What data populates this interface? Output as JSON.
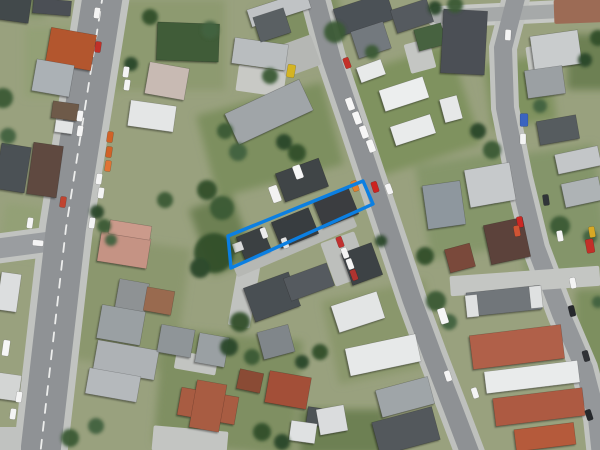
{
  "canvas": {
    "w": 600,
    "h": 450
  },
  "plot": {
    "outline_color": "#0b7fe2",
    "stroke_width": 3.4,
    "points": "228,236 363,181 373,204 231,268"
  },
  "scene": {
    "base_color": "#99a17e",
    "grass_colors": [
      "#8d9a70",
      "#93a076",
      "#7d8f5e",
      "#7f925e",
      "#85966a",
      "#8b976e",
      "#7f8f62",
      "#8a976c",
      "#84956a",
      "#6d8052"
    ],
    "grass": [
      [
        160,
        45,
        130,
        90,
        0,
        0
      ],
      [
        70,
        62,
        90,
        70,
        0,
        1
      ],
      [
        270,
        140,
        130,
        85,
        -15,
        2
      ],
      [
        408,
        112,
        120,
        105,
        -18,
        3
      ],
      [
        470,
        205,
        95,
        95,
        -10,
        4
      ],
      [
        118,
        302,
        130,
        125,
        8,
        5
      ],
      [
        228,
        392,
        140,
        115,
        5,
        6
      ],
      [
        382,
        332,
        105,
        85,
        -12,
        7
      ],
      [
        560,
        212,
        85,
        125,
        -8,
        8
      ],
      [
        300,
        22,
        85,
        45,
        -15,
        6
      ],
      [
        520,
        92,
        65,
        65,
        -8,
        3
      ],
      [
        598,
        332,
        45,
        85,
        0,
        2
      ],
      [
        32,
        232,
        60,
        50,
        8,
        1
      ],
      [
        342,
        432,
        85,
        45,
        0,
        9
      ],
      [
        590,
        62,
        45,
        55,
        0,
        9
      ],
      [
        588,
        5,
        30,
        20,
        0,
        6
      ],
      [
        25,
        5,
        40,
        25,
        0,
        4
      ],
      [
        222,
        235,
        45,
        70,
        -20,
        9
      ]
    ],
    "roads": [
      {
        "name": "side-street",
        "path": "M 54 241 L -6 249",
        "casing_w": 30,
        "casing_color": "#c1c3c0",
        "width": 20,
        "color": "#9a9da0"
      },
      {
        "name": "road-west",
        "path": "M 103 -6 L 66 228 L 40 456",
        "casing_w": 54,
        "casing_color": "#c1c3c0",
        "width": 40,
        "color": "#8f9295",
        "marking": "9 9"
      },
      {
        "name": "road-north-east",
        "path": "M 438 17 L 602 9",
        "casing_w": 22,
        "casing_color": "#c6c8c5",
        "width": 14,
        "color": "#a6a9a9"
      },
      {
        "name": "road-east",
        "path": "M 517 -6 L 503 48 L 505 108 L 519 178 L 536 248 L 561 314 L 584 368 L 597 418 L 601 456",
        "casing_w": 28,
        "casing_color": "#c1c3c0",
        "width": 18,
        "color": "#94979a"
      },
      {
        "name": "road-center",
        "path": "M 314 -6 L 331 58 L 352 120 L 372 180 L 392 240 L 412 300 L 433 357 L 452 406 L 471 456",
        "casing_w": 30,
        "casing_color": "#bec0bd",
        "width": 19,
        "color": "#8e9194"
      }
    ],
    "paved": [
      [
        261,
        81,
        48,
        26,
        8,
        "#c8c9c5"
      ],
      [
        420,
        56,
        26,
        30,
        -15,
        "#c4c6c3"
      ],
      [
        525,
        281,
        150,
        20,
        -4,
        "#c4c6c3"
      ],
      [
        345,
        259,
        36,
        46,
        -20,
        "#bdbfbc"
      ],
      [
        244,
        296,
        22,
        62,
        10,
        "#c0c2bf"
      ],
      [
        196,
        363,
        42,
        18,
        10,
        "#c2c4c1"
      ],
      [
        298,
        56,
        38,
        32,
        -20,
        "#b5b7b4"
      ],
      [
        190,
        441,
        75,
        25,
        5,
        "#c3c5c2"
      ],
      [
        5,
        441,
        32,
        28,
        0,
        "#c0c2c0"
      ],
      [
        543,
        65,
        30,
        40,
        -8,
        "#c2c4c0"
      ],
      [
        295,
        246,
        130,
        13,
        -23,
        "#b6b8b4"
      ],
      [
        580,
        11,
        52,
        24,
        -2,
        "#9c6b55"
      ]
    ],
    "buildings": [
      [
        12,
        9,
        36,
        24,
        8,
        "#43484c"
      ],
      [
        52,
        7,
        38,
        15,
        5,
        "#4b5054"
      ],
      [
        13,
        168,
        30,
        46,
        9,
        "#4c5155"
      ],
      [
        45,
        170,
        30,
        52,
        8,
        "#5e4a40"
      ],
      [
        9,
        292,
        20,
        38,
        8,
        "#dcdedf"
      ],
      [
        9,
        387,
        22,
        26,
        8,
        "#d3d5d4"
      ],
      [
        71,
        49,
        46,
        36,
        10,
        "#b3562f"
      ],
      [
        53,
        78,
        38,
        32,
        10,
        "#abb1b5"
      ],
      [
        65,
        111,
        26,
        17,
        8,
        "#6e5a48"
      ],
      [
        64,
        127,
        18,
        12,
        8,
        "#e3e5e5"
      ],
      [
        124,
        250,
        50,
        30,
        9,
        "#c59384"
      ],
      [
        130,
        230,
        42,
        14,
        9,
        "#cb9a8b"
      ],
      [
        132,
        296,
        30,
        30,
        10,
        "#8e9294"
      ],
      [
        159,
        301,
        28,
        24,
        10,
        "#996a50"
      ],
      [
        121,
        325,
        44,
        34,
        10,
        "#9aa0a3"
      ],
      [
        126,
        360,
        62,
        30,
        10,
        "#aeb2b5"
      ],
      [
        113,
        385,
        52,
        26,
        10,
        "#b5b9bc"
      ],
      [
        176,
        341,
        34,
        28,
        10,
        "#8f9598"
      ],
      [
        212,
        350,
        30,
        30,
        10,
        "#9aa0a3"
      ],
      [
        208,
        406,
        58,
        28,
        10,
        "#a85c42"
      ],
      [
        208,
        406,
        30,
        48,
        10,
        "#a85c42"
      ],
      [
        250,
        381,
        24,
        20,
        12,
        "#8a4c36"
      ],
      [
        288,
        390,
        42,
        32,
        10,
        "#a34f38"
      ],
      [
        318,
        417,
        22,
        18,
        8,
        "#4e5356"
      ],
      [
        303,
        432,
        26,
        20,
        8,
        "#dfe1e2"
      ],
      [
        188,
        42,
        62,
        38,
        2,
        "#3f5c39"
      ],
      [
        167,
        81,
        40,
        32,
        10,
        "#c8bab3"
      ],
      [
        152,
        116,
        46,
        26,
        8,
        "#e4e6e6"
      ],
      [
        260,
        54,
        54,
        26,
        8,
        "#b9bdbf"
      ],
      [
        269,
        112,
        82,
        34,
        -25,
        "#a0a5a8"
      ],
      [
        279,
        9,
        62,
        18,
        -18,
        "#c0c3c5"
      ],
      [
        272,
        25,
        32,
        26,
        -18,
        "#5a6064"
      ],
      [
        302,
        180,
        46,
        30,
        -20,
        "#3f4447"
      ],
      [
        364,
        14,
        56,
        28,
        -18,
        "#4c5156"
      ],
      [
        412,
        16,
        38,
        24,
        -18,
        "#555a5e"
      ],
      [
        371,
        40,
        34,
        28,
        -18,
        "#73797e"
      ],
      [
        430,
        37,
        28,
        22,
        -15,
        "#47623f"
      ],
      [
        254,
        244,
        28,
        26,
        -22,
        "#3b4043"
      ],
      [
        295,
        228,
        40,
        28,
        -22,
        "#393d40"
      ],
      [
        336,
        208,
        38,
        28,
        -22,
        "#3a3e41"
      ],
      [
        238,
        247,
        10,
        9,
        -20,
        "#d8dada"
      ],
      [
        371,
        71,
        26,
        16,
        -20,
        "#e8eaea"
      ],
      [
        404,
        94,
        46,
        22,
        -18,
        "#eceeee"
      ],
      [
        413,
        130,
        42,
        20,
        -18,
        "#e9ebeb"
      ],
      [
        451,
        109,
        18,
        24,
        -15,
        "#e6e8e8"
      ],
      [
        464,
        42,
        44,
        64,
        3,
        "#4b5054"
      ],
      [
        556,
        50,
        48,
        34,
        -8,
        "#c9cccd"
      ],
      [
        545,
        82,
        38,
        28,
        -8,
        "#9ba0a3"
      ],
      [
        578,
        160,
        44,
        20,
        -12,
        "#c3c6c8"
      ],
      [
        582,
        192,
        38,
        24,
        -12,
        "#aeb3b5"
      ],
      [
        558,
        130,
        40,
        24,
        -10,
        "#565b5f"
      ],
      [
        490,
        185,
        46,
        38,
        -10,
        "#c6c9cb"
      ],
      [
        444,
        205,
        38,
        44,
        -8,
        "#8e979e"
      ],
      [
        507,
        241,
        40,
        40,
        -12,
        "#5c423a"
      ],
      [
        460,
        258,
        26,
        24,
        -15,
        "#7a4a3a"
      ],
      [
        362,
        264,
        32,
        34,
        -20,
        "#3d4245"
      ],
      [
        272,
        297,
        48,
        36,
        -20,
        "#4a4f53"
      ],
      [
        309,
        282,
        46,
        24,
        -20,
        "#555a5e"
      ],
      [
        276,
        342,
        32,
        28,
        -15,
        "#80868a"
      ],
      [
        358,
        312,
        48,
        28,
        -18,
        "#e3e5e5"
      ],
      [
        383,
        355,
        72,
        28,
        -12,
        "#e7e9e9"
      ],
      [
        405,
        397,
        54,
        28,
        -15,
        "#9fa5a8"
      ],
      [
        406,
        431,
        62,
        34,
        -15,
        "#53585c"
      ],
      [
        332,
        420,
        28,
        26,
        -10,
        "#dadcdd"
      ],
      [
        504,
        301,
        74,
        24,
        -6,
        "#71767a"
      ],
      [
        472,
        306,
        12,
        22,
        -6,
        "#dfe1e1"
      ],
      [
        536,
        297,
        12,
        22,
        -6,
        "#dfe1e1"
      ],
      [
        517,
        347,
        92,
        34,
        -7,
        "#b06048"
      ],
      [
        532,
        377,
        94,
        22,
        -7,
        "#e9ebeb"
      ],
      [
        539,
        407,
        90,
        28,
        -7,
        "#ad5a42"
      ],
      [
        545,
        437,
        60,
        22,
        -7,
        "#b55a3a"
      ]
    ],
    "tree_colors": [
      "#30502c",
      "#3b5a35",
      "#2b472a",
      "#436240"
    ],
    "trees": [
      [
        214,
        253,
        20,
        0
      ],
      [
        200,
        268,
        10,
        2
      ],
      [
        222,
        208,
        12,
        1
      ],
      [
        207,
        190,
        10,
        0
      ],
      [
        238,
        152,
        9,
        3
      ],
      [
        225,
        131,
        8,
        1
      ],
      [
        297,
        153,
        9,
        0
      ],
      [
        284,
        142,
        8,
        2
      ],
      [
        335,
        32,
        11,
        1
      ],
      [
        210,
        30,
        9,
        3
      ],
      [
        270,
        76,
        8,
        1
      ],
      [
        150,
        17,
        8,
        0
      ],
      [
        131,
        64,
        7,
        2
      ],
      [
        3,
        98,
        10,
        1
      ],
      [
        8,
        136,
        8,
        3
      ],
      [
        165,
        200,
        8,
        1
      ],
      [
        97,
        212,
        7,
        2
      ],
      [
        104,
        226,
        7,
        1
      ],
      [
        111,
        240,
        6,
        3
      ],
      [
        240,
        322,
        10,
        0
      ],
      [
        229,
        347,
        9,
        2
      ],
      [
        252,
        357,
        8,
        1
      ],
      [
        320,
        352,
        8,
        0
      ],
      [
        302,
        362,
        7,
        2
      ],
      [
        436,
        301,
        10,
        1
      ],
      [
        449,
        322,
        8,
        3
      ],
      [
        425,
        256,
        9,
        0
      ],
      [
        560,
        226,
        10,
        1
      ],
      [
        590,
        237,
        7,
        3
      ],
      [
        478,
        131,
        8,
        2
      ],
      [
        492,
        150,
        9,
        1
      ],
      [
        540,
        106,
        7,
        3
      ],
      [
        381,
        241,
        6,
        2
      ],
      [
        70,
        438,
        9,
        1
      ],
      [
        96,
        426,
        8,
        3
      ],
      [
        262,
        432,
        9,
        0
      ],
      [
        282,
        442,
        8,
        2
      ],
      [
        372,
        52,
        7,
        1
      ],
      [
        598,
        302,
        6,
        3
      ],
      [
        598,
        38,
        8,
        0
      ],
      [
        585,
        60,
        7,
        2
      ],
      [
        455,
        5,
        8,
        1
      ],
      [
        435,
        8,
        7,
        2
      ]
    ],
    "vehicles": [
      [
        97,
        13,
        8,
        "#f4f4f4"
      ],
      [
        98,
        47,
        8,
        "#c03028"
      ],
      [
        126,
        72,
        8,
        "#f4f4f4"
      ],
      [
        127,
        85,
        8,
        "#f4f4f4"
      ],
      [
        80,
        116,
        8,
        "#f4f4f4"
      ],
      [
        80,
        131,
        8,
        "#f4f4f4"
      ],
      [
        110,
        137,
        8,
        "#d06228"
      ],
      [
        109,
        152,
        8,
        "#d06228"
      ],
      [
        108,
        166,
        8,
        "#e07434"
      ],
      [
        99,
        179,
        8,
        "#f4f4f4"
      ],
      [
        101,
        193,
        8,
        "#f4f4f4"
      ],
      [
        63,
        202,
        8,
        "#c04430"
      ],
      [
        92,
        223,
        8,
        "#f4f4f4"
      ],
      [
        30,
        223,
        8,
        "#f4f4f4"
      ],
      [
        38,
        243,
        95,
        "#f4f4f4"
      ],
      [
        6,
        348,
        8,
        "#f6f6f6",
        7,
        16
      ],
      [
        19,
        397,
        8,
        "#f4f4f4"
      ],
      [
        13,
        414,
        8,
        "#f4f4f4"
      ],
      [
        298,
        172,
        -20,
        "#f6f6f6",
        8,
        14
      ],
      [
        275,
        194,
        -20,
        "#f2f2f2",
        9,
        17
      ],
      [
        350,
        104,
        -20,
        "#f6f6f6",
        7,
        13
      ],
      [
        357,
        118,
        -20,
        "#f6f6f6",
        7,
        13
      ],
      [
        364,
        132,
        -20,
        "#f6f6f6",
        7,
        13
      ],
      [
        371,
        146,
        -20,
        "#f6f6f6",
        7,
        13
      ],
      [
        355,
        186,
        -20,
        "#e08030"
      ],
      [
        375,
        187,
        -18,
        "#cc2420"
      ],
      [
        389,
        189,
        -20,
        "#f4f4f4"
      ],
      [
        347,
        63,
        -20,
        "#c43028"
      ],
      [
        264,
        233,
        -20,
        "#ececec"
      ],
      [
        285,
        243,
        -20,
        "#e2e2e2"
      ],
      [
        340,
        242,
        -20,
        "#c03030"
      ],
      [
        345,
        253,
        -20,
        "#f4f4f4"
      ],
      [
        350,
        264,
        -20,
        "#f4f4f4"
      ],
      [
        354,
        275,
        -20,
        "#b03430"
      ],
      [
        443,
        316,
        -18,
        "#f6f6f6",
        8,
        16
      ],
      [
        448,
        376,
        -18,
        "#f4f4f4"
      ],
      [
        475,
        393,
        -18,
        "#f4f4f4"
      ],
      [
        508,
        35,
        3,
        "#f4f4f4"
      ],
      [
        524,
        120,
        0,
        "#3a64c0",
        8,
        13
      ],
      [
        523,
        139,
        0,
        "#f4f4f4"
      ],
      [
        546,
        200,
        -8,
        "#303438"
      ],
      [
        560,
        236,
        -10,
        "#f4f4f4"
      ],
      [
        590,
        246,
        -10,
        "#c23028",
        8,
        14
      ],
      [
        520,
        222,
        -10,
        "#cc2824"
      ],
      [
        517,
        231,
        -10,
        "#d05434"
      ],
      [
        573,
        283,
        -12,
        "#f4f4f4"
      ],
      [
        572,
        311,
        -14,
        "#26282c"
      ],
      [
        586,
        356,
        -16,
        "#303236"
      ],
      [
        589,
        415,
        -18,
        "#26282c"
      ],
      [
        291,
        71,
        10,
        "#d4b422",
        8,
        13
      ],
      [
        592,
        232,
        -10,
        "#d8a824"
      ]
    ]
  }
}
